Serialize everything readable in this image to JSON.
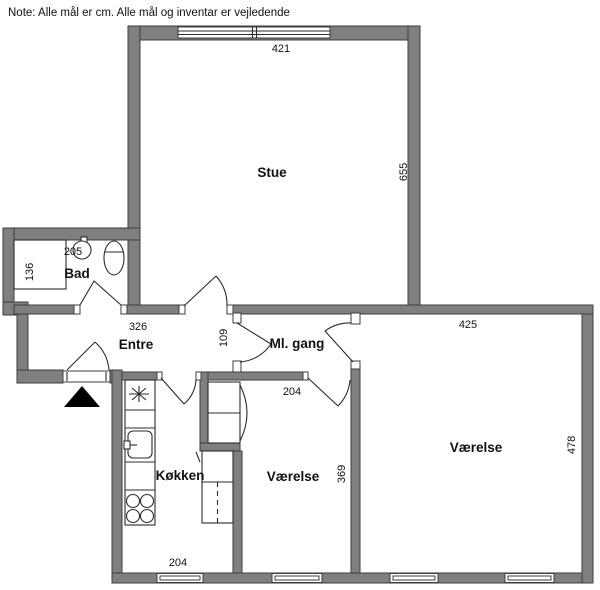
{
  "note": "Note: Alle mål er cm. Alle mål og inventar er vejledende",
  "colors": {
    "wall": "#7f7f7f",
    "wall_stroke": "#3d3d3d",
    "line": "#2b2b2b",
    "background": "#ffffff",
    "entrance_arrow": "#000000"
  },
  "rooms": {
    "stue": {
      "name": "Stue",
      "width_cm": "421",
      "height_cm": "655"
    },
    "bad": {
      "name": "Bad",
      "width_cm": "205",
      "depth_cm": "136"
    },
    "entre": {
      "name": "Entre",
      "width_cm": "326"
    },
    "mlgang": {
      "name": "Ml. gang",
      "opening_cm": "109"
    },
    "vaerelse_right": {
      "name": "Værelse",
      "width_cm": "425",
      "height_cm": "478"
    },
    "vaerelse_mid": {
      "name": "Værelse",
      "width_cm": "204",
      "height_cm": "369"
    },
    "koekken": {
      "name": "Køkken",
      "width_cm": "204"
    }
  },
  "fixtures": {
    "bathroom": [
      "shower",
      "sink",
      "toilet"
    ],
    "kitchen": [
      "fan-symbol",
      "kitchen-sink",
      "stove-4-burners",
      "counter",
      "tall-cabinet"
    ],
    "entrance": [
      "entrance-door",
      "entrance-arrow"
    ]
  }
}
